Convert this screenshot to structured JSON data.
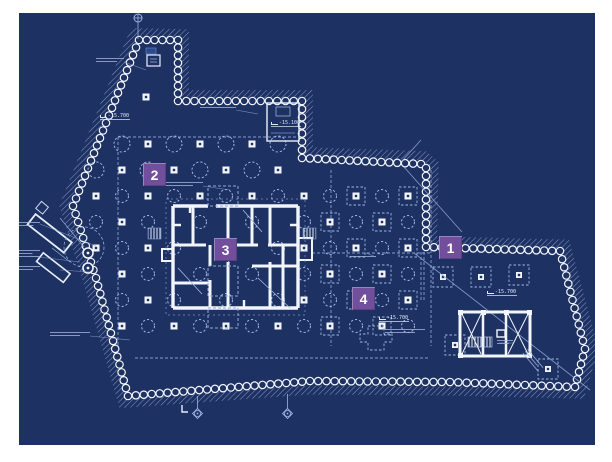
{
  "page": {
    "background": "#ffffff"
  },
  "blueprint": {
    "description": "excavation and piling site plan",
    "background": "#1e3163",
    "line_color": "#8fa9d8",
    "line_color_bright": "#b9c8e6",
    "wall_color": "#f2f5fb",
    "marker_color": "#714f9d",
    "markers": [
      {
        "label": "1"
      },
      {
        "label": "2"
      },
      {
        "label": "3"
      },
      {
        "label": "4"
      }
    ],
    "elevation_labels": [
      {
        "text": "-15.700"
      },
      {
        "text": "-15.100"
      },
      {
        "text": "-15.700"
      },
      {
        "text": "-15.700"
      }
    ]
  }
}
